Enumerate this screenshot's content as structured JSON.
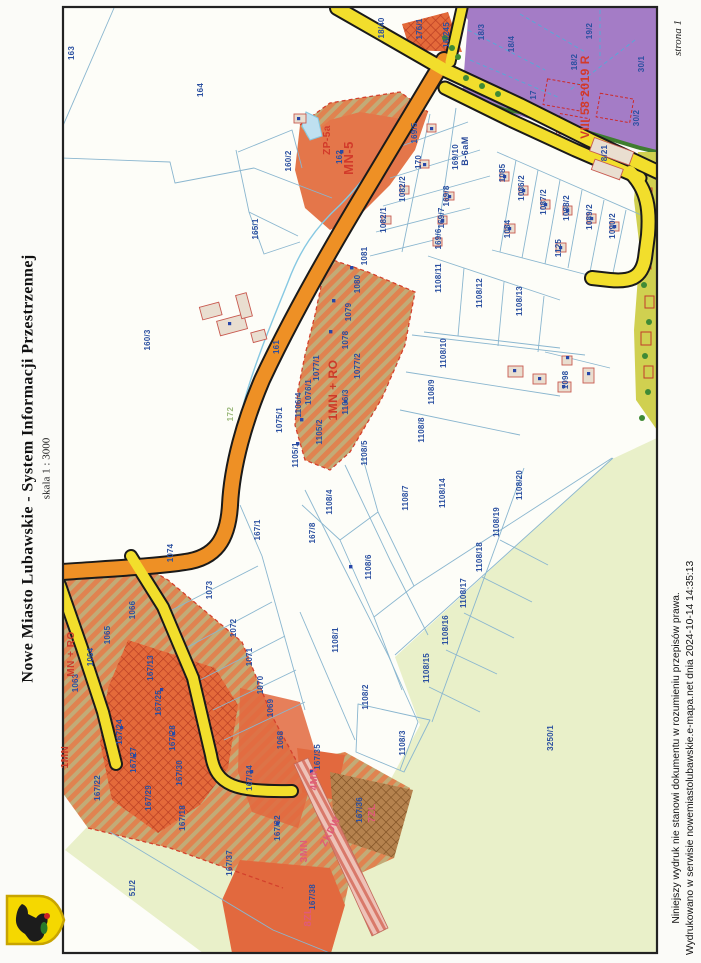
{
  "page": {
    "title": "Nowe Miasto Lubawskie - System Informacji Przestrzennej",
    "scale": "skala 1 : 3000",
    "page_number": "strona 1",
    "disclaimer_line1": "Niniejszy wydruk nie stanowi dokumentu w rozumieniu przepisów prawa.",
    "disclaimer_line2": "Wydrukowano w serwisie nowemiastolubawskie.e-mapa.net dnia 2024-10-14 14:35:13"
  },
  "colors": {
    "yellow_road": "#f2de2c",
    "orange_road": "#ee9025",
    "purple_zone": "#a47cc6",
    "light_green": "#e9f0c9",
    "hatch_orange": "#e08350",
    "parcel_label_blue": "#2a4fa0",
    "zone_label_red": "#d23a2a",
    "zone_label_pink": "#e05a78"
  },
  "map": {
    "zone_labels": [
      {
        "t": "ZP-5a",
        "x": 330,
        "y": 140,
        "c": "#d23a2a",
        "s": 10
      },
      {
        "t": "MN-5",
        "x": 353,
        "y": 158,
        "c": "#d23a2a",
        "s": 13
      },
      {
        "t": "1MN + RO",
        "x": 337,
        "y": 390,
        "c": "#cc3a2a",
        "s": 12
      },
      {
        "t": "MN + RO",
        "x": 74,
        "y": 654,
        "c": "#cc3a2a",
        "s": 10
      },
      {
        "t": "1MN",
        "x": 68,
        "y": 757,
        "c": "#cc3a2a",
        "s": 10
      },
      {
        "t": "VIII 58 2019 R",
        "x": 589,
        "y": 97,
        "c": "#d23a2a",
        "s": 12
      },
      {
        "t": "B-6aM",
        "x": 468,
        "y": 151,
        "c": "#2a4a9a",
        "s": 9
      },
      {
        "t": "4MN",
        "x": 317,
        "y": 779,
        "c": "#e05a78",
        "s": 10
      },
      {
        "t": "3MN",
        "x": 307,
        "y": 851,
        "c": "#e05a78",
        "s": 10
      },
      {
        "t": "8ZL",
        "x": 311,
        "y": 917,
        "c": "#e05a78",
        "s": 10
      },
      {
        "t": "7ZL",
        "x": 375,
        "y": 813,
        "c": "#e05a78",
        "s": 10
      },
      {
        "t": "ZKDW",
        "x": 333,
        "y": 833,
        "c": "#e05a78",
        "s": 10,
        "r": -62
      },
      {
        "t": "172",
        "x": 233,
        "y": 414,
        "c": "#9ab87a",
        "s": 8
      }
    ],
    "parcel_labels": [
      {
        "t": "163",
        "x": 74,
        "y": 53
      },
      {
        "t": "164",
        "x": 203,
        "y": 90
      },
      {
        "t": "160/2",
        "x": 291,
        "y": 161
      },
      {
        "t": "165/1",
        "x": 258,
        "y": 229
      },
      {
        "t": "162",
        "x": 342,
        "y": 157
      },
      {
        "t": "160/3",
        "x": 150,
        "y": 340
      },
      {
        "t": "161",
        "x": 279,
        "y": 347
      },
      {
        "t": "1075/1",
        "x": 282,
        "y": 420
      },
      {
        "t": "169/5",
        "x": 417,
        "y": 133
      },
      {
        "t": "170",
        "x": 421,
        "y": 162
      },
      {
        "t": "169/10",
        "x": 458,
        "y": 157
      },
      {
        "t": "169/8",
        "x": 449,
        "y": 196
      },
      {
        "t": "169/7",
        "x": 444,
        "y": 218
      },
      {
        "t": "169/6",
        "x": 441,
        "y": 239
      },
      {
        "t": "1082/2",
        "x": 405,
        "y": 189
      },
      {
        "t": "1082/1",
        "x": 386,
        "y": 220
      },
      {
        "t": "1085",
        "x": 505,
        "y": 173
      },
      {
        "t": "1086/2",
        "x": 524,
        "y": 188
      },
      {
        "t": "1087/2",
        "x": 546,
        "y": 202
      },
      {
        "t": "1088/2",
        "x": 569,
        "y": 208
      },
      {
        "t": "1089/2",
        "x": 592,
        "y": 217
      },
      {
        "t": "1090/2",
        "x": 615,
        "y": 226
      },
      {
        "t": "1084",
        "x": 510,
        "y": 229
      },
      {
        "t": "1125",
        "x": 561,
        "y": 248
      },
      {
        "t": "8/21",
        "x": 607,
        "y": 153
      },
      {
        "t": "16/245",
        "x": 449,
        "y": 35
      },
      {
        "t": "176/1",
        "x": 422,
        "y": 29
      },
      {
        "t": "18/40",
        "x": 384,
        "y": 28
      },
      {
        "t": "18/3",
        "x": 484,
        "y": 32
      },
      {
        "t": "18/4",
        "x": 514,
        "y": 44
      },
      {
        "t": "19/2",
        "x": 592,
        "y": 31
      },
      {
        "t": "18/2",
        "x": 577,
        "y": 62
      },
      {
        "t": "30/1",
        "x": 644,
        "y": 64
      },
      {
        "t": "17",
        "x": 536,
        "y": 95
      },
      {
        "t": "30/2",
        "x": 639,
        "y": 118
      },
      {
        "t": "1081",
        "x": 367,
        "y": 256
      },
      {
        "t": "1080",
        "x": 360,
        "y": 284
      },
      {
        "t": "1079",
        "x": 351,
        "y": 312
      },
      {
        "t": "1078",
        "x": 348,
        "y": 340
      },
      {
        "t": "1077/1",
        "x": 319,
        "y": 368
      },
      {
        "t": "1077/2",
        "x": 360,
        "y": 366
      },
      {
        "t": "1076/1",
        "x": 311,
        "y": 392
      },
      {
        "t": "1106/4",
        "x": 301,
        "y": 405
      },
      {
        "t": "1106/3",
        "x": 348,
        "y": 402
      },
      {
        "t": "1105/2",
        "x": 322,
        "y": 432
      },
      {
        "t": "1105/1",
        "x": 298,
        "y": 455
      },
      {
        "t": "1108/11",
        "x": 441,
        "y": 278
      },
      {
        "t": "1108/12",
        "x": 482,
        "y": 293
      },
      {
        "t": "1108/13",
        "x": 522,
        "y": 301
      },
      {
        "t": "1108/10",
        "x": 446,
        "y": 353
      },
      {
        "t": "1108/9",
        "x": 434,
        "y": 392
      },
      {
        "t": "1108/8",
        "x": 424,
        "y": 430
      },
      {
        "t": "1108/5",
        "x": 367,
        "y": 453
      },
      {
        "t": "1108/4",
        "x": 332,
        "y": 502
      },
      {
        "t": "1108/7",
        "x": 408,
        "y": 498
      },
      {
        "t": "1108/14",
        "x": 445,
        "y": 493
      },
      {
        "t": "167/8",
        "x": 315,
        "y": 533
      },
      {
        "t": "1108/6",
        "x": 371,
        "y": 567
      },
      {
        "t": "1108/1",
        "x": 338,
        "y": 640
      },
      {
        "t": "1108/2",
        "x": 368,
        "y": 697
      },
      {
        "t": "1108/15",
        "x": 429,
        "y": 668
      },
      {
        "t": "1108/16",
        "x": 448,
        "y": 630
      },
      {
        "t": "1108/17",
        "x": 466,
        "y": 593
      },
      {
        "t": "1108/18",
        "x": 482,
        "y": 557
      },
      {
        "t": "1108/19",
        "x": 499,
        "y": 522
      },
      {
        "t": "1108/20",
        "x": 522,
        "y": 485
      },
      {
        "t": "1108/3",
        "x": 405,
        "y": 743
      },
      {
        "t": "1098",
        "x": 568,
        "y": 380
      },
      {
        "t": "167/1",
        "x": 260,
        "y": 530
      },
      {
        "t": "1074",
        "x": 173,
        "y": 553
      },
      {
        "t": "1073",
        "x": 212,
        "y": 590
      },
      {
        "t": "1072",
        "x": 236,
        "y": 628
      },
      {
        "t": "1071",
        "x": 252,
        "y": 657
      },
      {
        "t": "1070",
        "x": 263,
        "y": 685
      },
      {
        "t": "1069",
        "x": 273,
        "y": 708
      },
      {
        "t": "1068",
        "x": 283,
        "y": 740
      },
      {
        "t": "1066",
        "x": 135,
        "y": 610
      },
      {
        "t": "1065",
        "x": 110,
        "y": 635
      },
      {
        "t": "1064",
        "x": 93,
        "y": 657
      },
      {
        "t": "1063",
        "x": 78,
        "y": 683
      },
      {
        "t": "167/13",
        "x": 153,
        "y": 668
      },
      {
        "t": "167/25",
        "x": 161,
        "y": 703
      },
      {
        "t": "167/24",
        "x": 122,
        "y": 732
      },
      {
        "t": "167/28",
        "x": 175,
        "y": 738
      },
      {
        "t": "167/27",
        "x": 136,
        "y": 760
      },
      {
        "t": "167/22",
        "x": 100,
        "y": 788
      },
      {
        "t": "167/29",
        "x": 151,
        "y": 798
      },
      {
        "t": "167/30",
        "x": 182,
        "y": 773
      },
      {
        "t": "167/18",
        "x": 185,
        "y": 818
      },
      {
        "t": "167/34",
        "x": 252,
        "y": 778
      },
      {
        "t": "167/32",
        "x": 280,
        "y": 828
      },
      {
        "t": "167/37",
        "x": 232,
        "y": 863
      },
      {
        "t": "51/2",
        "x": 135,
        "y": 888
      },
      {
        "t": "167/35",
        "x": 320,
        "y": 757
      },
      {
        "t": "167/36",
        "x": 362,
        "y": 810
      },
      {
        "t": "167/38",
        "x": 315,
        "y": 897
      },
      {
        "t": "3250/1",
        "x": 553,
        "y": 738
      }
    ]
  }
}
